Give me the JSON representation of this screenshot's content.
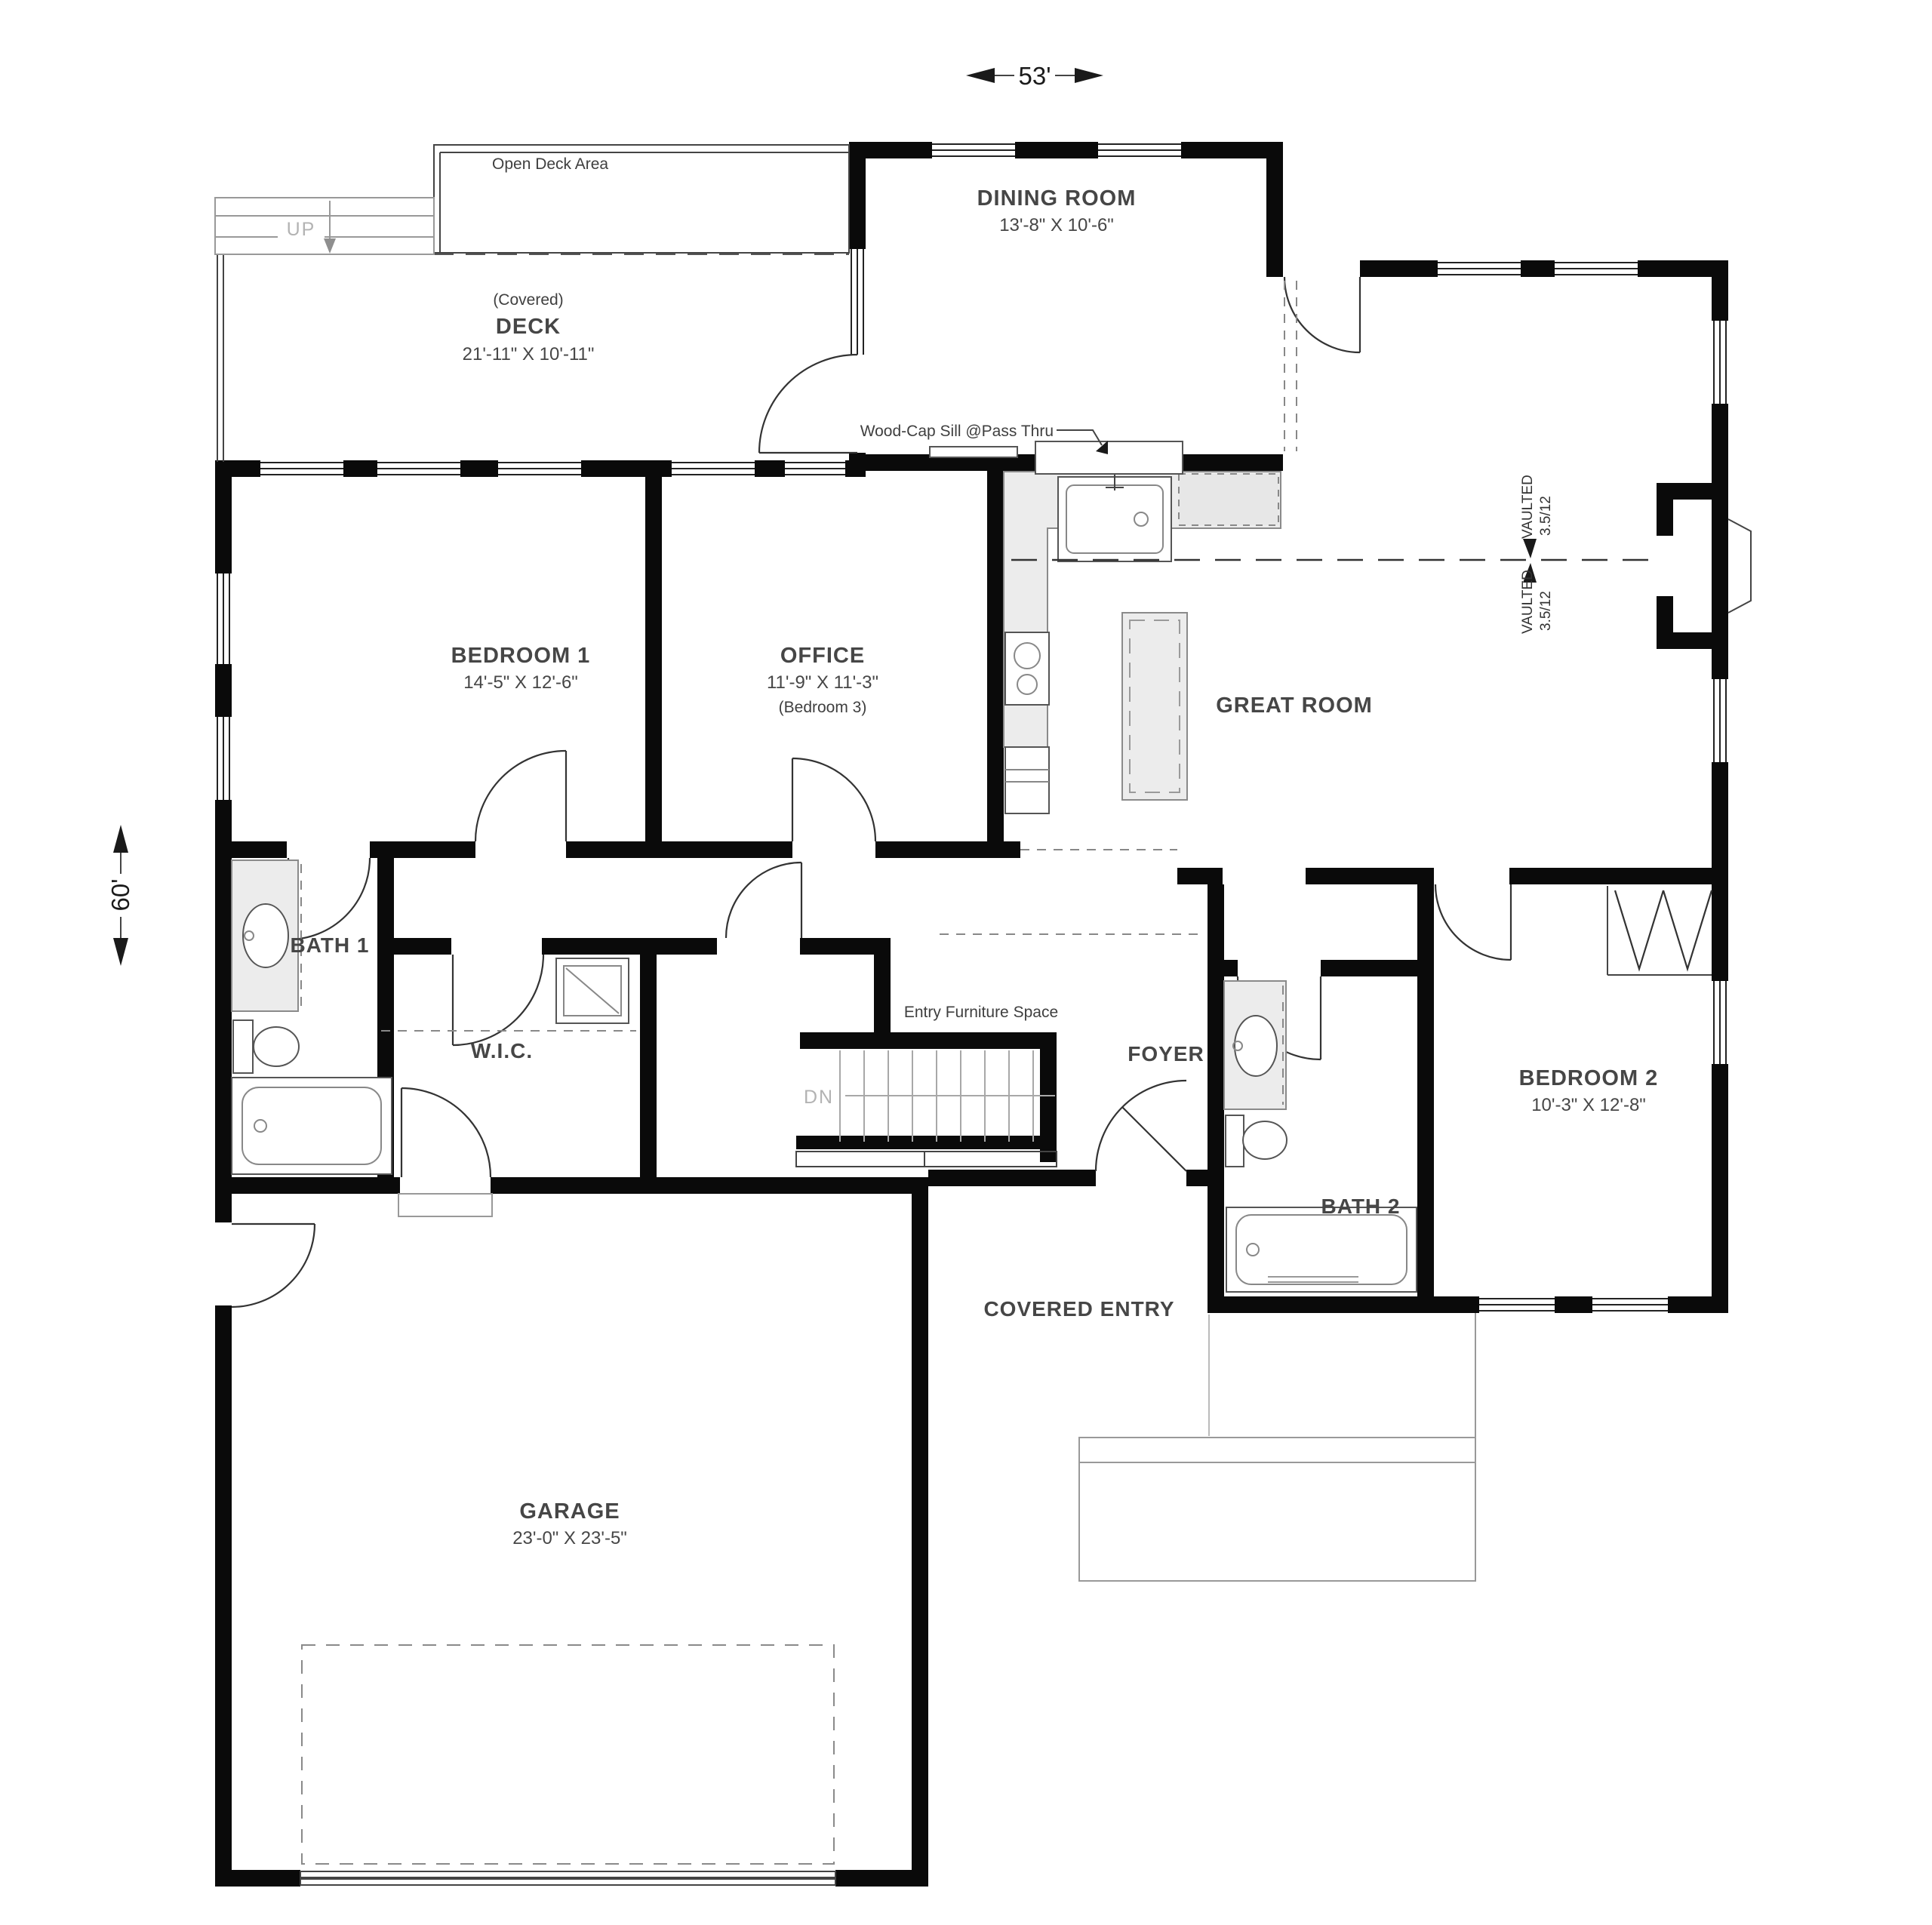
{
  "plan": {
    "title": "First floor plan",
    "dimensions": {
      "width_label": "53'",
      "height_label": "60'"
    },
    "rooms": {
      "dining": {
        "name": "DINING ROOM",
        "size": "13'-8\" X 10'-6\""
      },
      "deck": {
        "prefix": "(Covered)",
        "name": "DECK",
        "size": "21'-11\" X 10'-11\""
      },
      "open_deck": {
        "label": "Open Deck Area"
      },
      "bedroom1": {
        "name": "BEDROOM 1",
        "size": "14'-5\" X 12'-6\""
      },
      "office": {
        "name": "OFFICE",
        "size": "11'-9\" X 11'-3\"",
        "alt": "(Bedroom 3)"
      },
      "great_room": {
        "name": "GREAT ROOM"
      },
      "bath1": {
        "name": "BATH 1"
      },
      "wic": {
        "name": "W.I.C."
      },
      "foyer": {
        "name": "FOYER"
      },
      "bedroom2": {
        "name": "BEDROOM 2",
        "size": "10'-3\" X 12'-8\""
      },
      "bath2": {
        "name": "BATH 2"
      },
      "covered_entry": {
        "name": "COVERED ENTRY"
      },
      "garage": {
        "name": "GARAGE",
        "size": "23'-0\" X 23'-5\""
      }
    },
    "annotations": {
      "pass_thru": "Wood-Cap Sill @Pass Thru",
      "entry_furniture": "Entry Furniture Space",
      "vaulted": "VAULTED",
      "vault_pitch": "3.5/12",
      "stairs_up": "UP",
      "stairs_down": "DN"
    },
    "colors": {
      "wall": "#0a0a0a",
      "label": "#464646",
      "fixture_fill": "#ececec",
      "light_text": "#b3b3b3"
    }
  }
}
